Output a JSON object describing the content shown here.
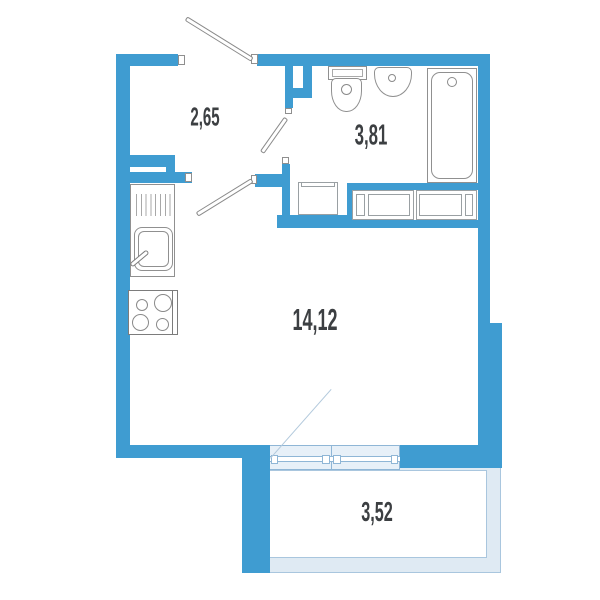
{
  "plan": {
    "title": "studio-apartment-floor-plan",
    "rooms": [
      {
        "id": "hallway",
        "area_label": "2,65"
      },
      {
        "id": "bathroom",
        "area_label": "3,81"
      },
      {
        "id": "living-room",
        "area_label": "14,12"
      },
      {
        "id": "balcony",
        "area_label": "3,52"
      }
    ],
    "fixtures": [
      "entrance-door",
      "interior-door",
      "bathroom-door",
      "toilet",
      "sink",
      "bathtub",
      "washing-machine",
      "wardrobe",
      "kitchen-counter",
      "kitchen-sink",
      "stove",
      "balcony-window",
      "balcony-door-swing"
    ],
    "colors": {
      "wall": "#3F9CD1",
      "balcony_fill": "#dfeaf3",
      "balcony_line": "#a9c6de",
      "glazing_fill": "#e7f0f8",
      "glazing_line": "#8fb6d6",
      "fixture_line": "#909090",
      "label_text": "#3c3f42"
    }
  }
}
